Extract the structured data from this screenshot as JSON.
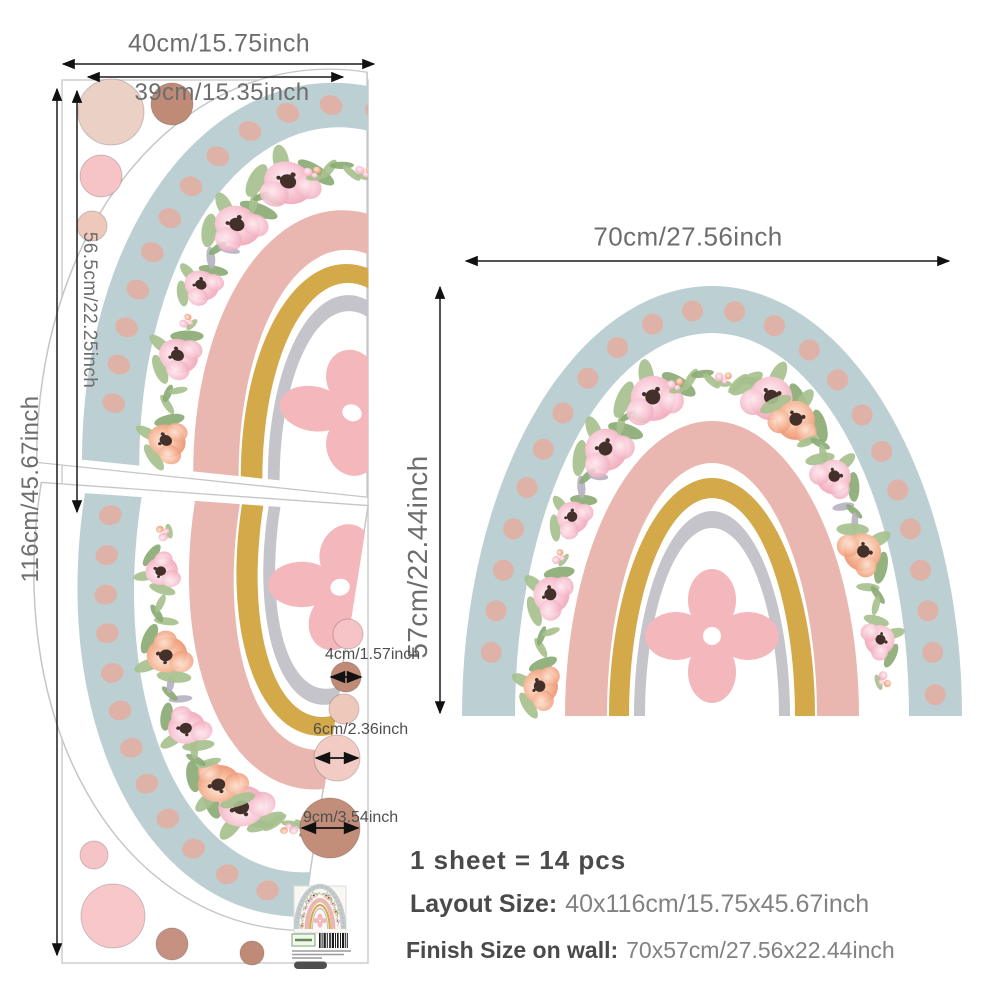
{
  "sheet": {
    "width_label": "40cm/15.75inch",
    "inner_width_label": "39cm/15.35inch",
    "height_label": "116cm/45.67inch",
    "piece_height_label": "56.5cm/22.25inch"
  },
  "finish": {
    "width_label": "70cm/27.56inch",
    "height_label": "57cm/22.44inch"
  },
  "dot_sizes": {
    "small_label": "4cm/1.57inch",
    "medium_label": "6cm/2.36inch",
    "large_label": "9cm/3.54inch"
  },
  "summary": {
    "line1": "1 sheet = 14 pcs",
    "line2_label": "Layout Size:",
    "line2_value": "40x116cm/15.75x45.67inch",
    "line3_label": "Finish Size on wall:",
    "line3_value": "70x57cm/27.56x22.44inch"
  },
  "palette": {
    "blue_band": "#bccfd3",
    "pink_band": "#e9b6b0",
    "yellow_band": "#d3a94a",
    "gray_band": "#c5c4ca",
    "polka_dot": "#dfb2a8",
    "flower_pink": "#f3aec0",
    "flower_coral": "#f09d7c",
    "flower_center": "#43302a",
    "leaf": "#a7c18e",
    "leaf_dark": "#8aab74",
    "leaf_gray": "#b6b2c0",
    "center_flower": "#f3b7bc",
    "circle_tan": "#ead0c5",
    "circle_brown": "#c08b76",
    "circle_pink": "#f6c3c6",
    "circle_light": "#eec9bb",
    "circle_light2": "#f2cbc4",
    "circle_brown2": "#c28e7a",
    "circle_brown3": "#c69180",
    "circle_pink_big": "#f8c7ca"
  }
}
